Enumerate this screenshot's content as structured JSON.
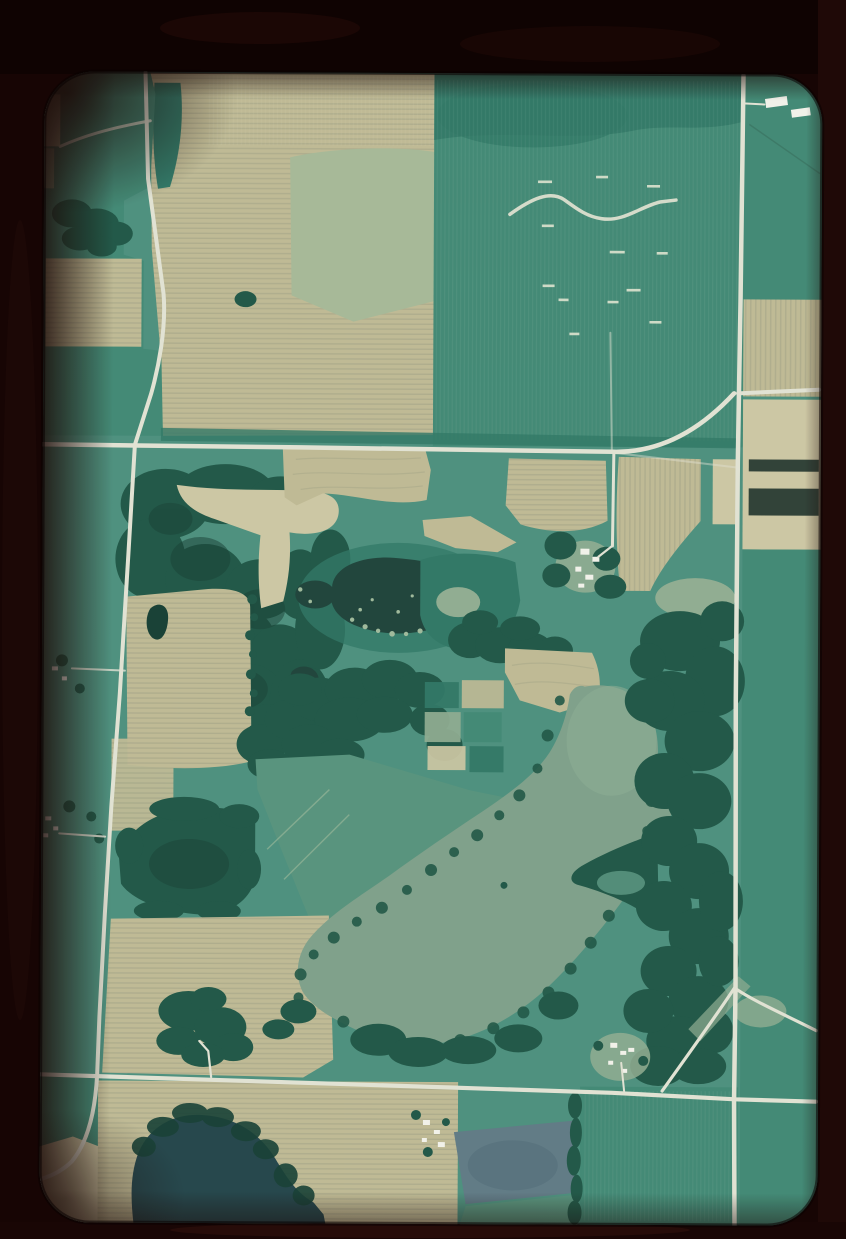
{
  "meta": {
    "artifact": "35mm color slide of an aerial photograph",
    "scene": "Aerial view of rural farmland: plowed tan fields with crop rows, green crop fields and pastures, dark woodlots, a dark wetland pond, a large pale lake, a dark lake at the bottom edge, a slate-blue field, and white-roofed farmsteads along straight section-line roads",
    "text_content_visible": "none"
  },
  "palette": {
    "mount": "#170504",
    "mount_top": "#0f0302",
    "mount_right": "#1f0907",
    "mount_bottom": "#190605",
    "photo_base_green": "#4a9180",
    "field_green": "#3f8a77",
    "field_green_dark": "#2d7868",
    "pasture_green": "#55947f",
    "pale_pasture": "#a6bb9b",
    "clearing_sage": "#8fae94",
    "field_tan": "#bfbc97",
    "field_tan_light": "#cdc9a7",
    "row_stripe": "#aeae8f",
    "forest_green": "#1d5748",
    "forest_dark": "#133f36",
    "pond_dark": "#1c433c",
    "lake_pale": "#7da28d",
    "lake_pale_light": "#8aad96",
    "lake_dark": "#21454c",
    "field_slate_blue": "#5e7b88",
    "road_light": "#e2e5d8",
    "building_white": "#f3f5ef",
    "marsh_speckle": "#9fbc9f",
    "creek_light": "#d6decf",
    "dark_till_strip": "#2c4038",
    "vignette": "#140403"
  },
  "features": {
    "mount_label": "dark film slide mount",
    "photo_label": "aerial photograph of farmland with lakes, woodlots and rural roads",
    "west_road_label": "west section road",
    "east_road_label": "east section road",
    "main_crossroad_label": "main east-west crossroad",
    "south_crossroad_label": "south east-west crossroad",
    "farm_lane_label": "farm lane to center farmstead",
    "creek_label": "winding drainage creek",
    "dark_pond_label": "dark wetland pond",
    "pale_lake_label": "large pale lake",
    "dark_lake_label": "dark lake at bottom edge",
    "slate_field_label": "slate-blue field",
    "ne_farm_label": "northeast farmstead with white roofs",
    "center_farm_label": "center farmstead",
    "west_farms_label": "farmsteads along west road",
    "se_farm_label": "farmstead near south road"
  }
}
